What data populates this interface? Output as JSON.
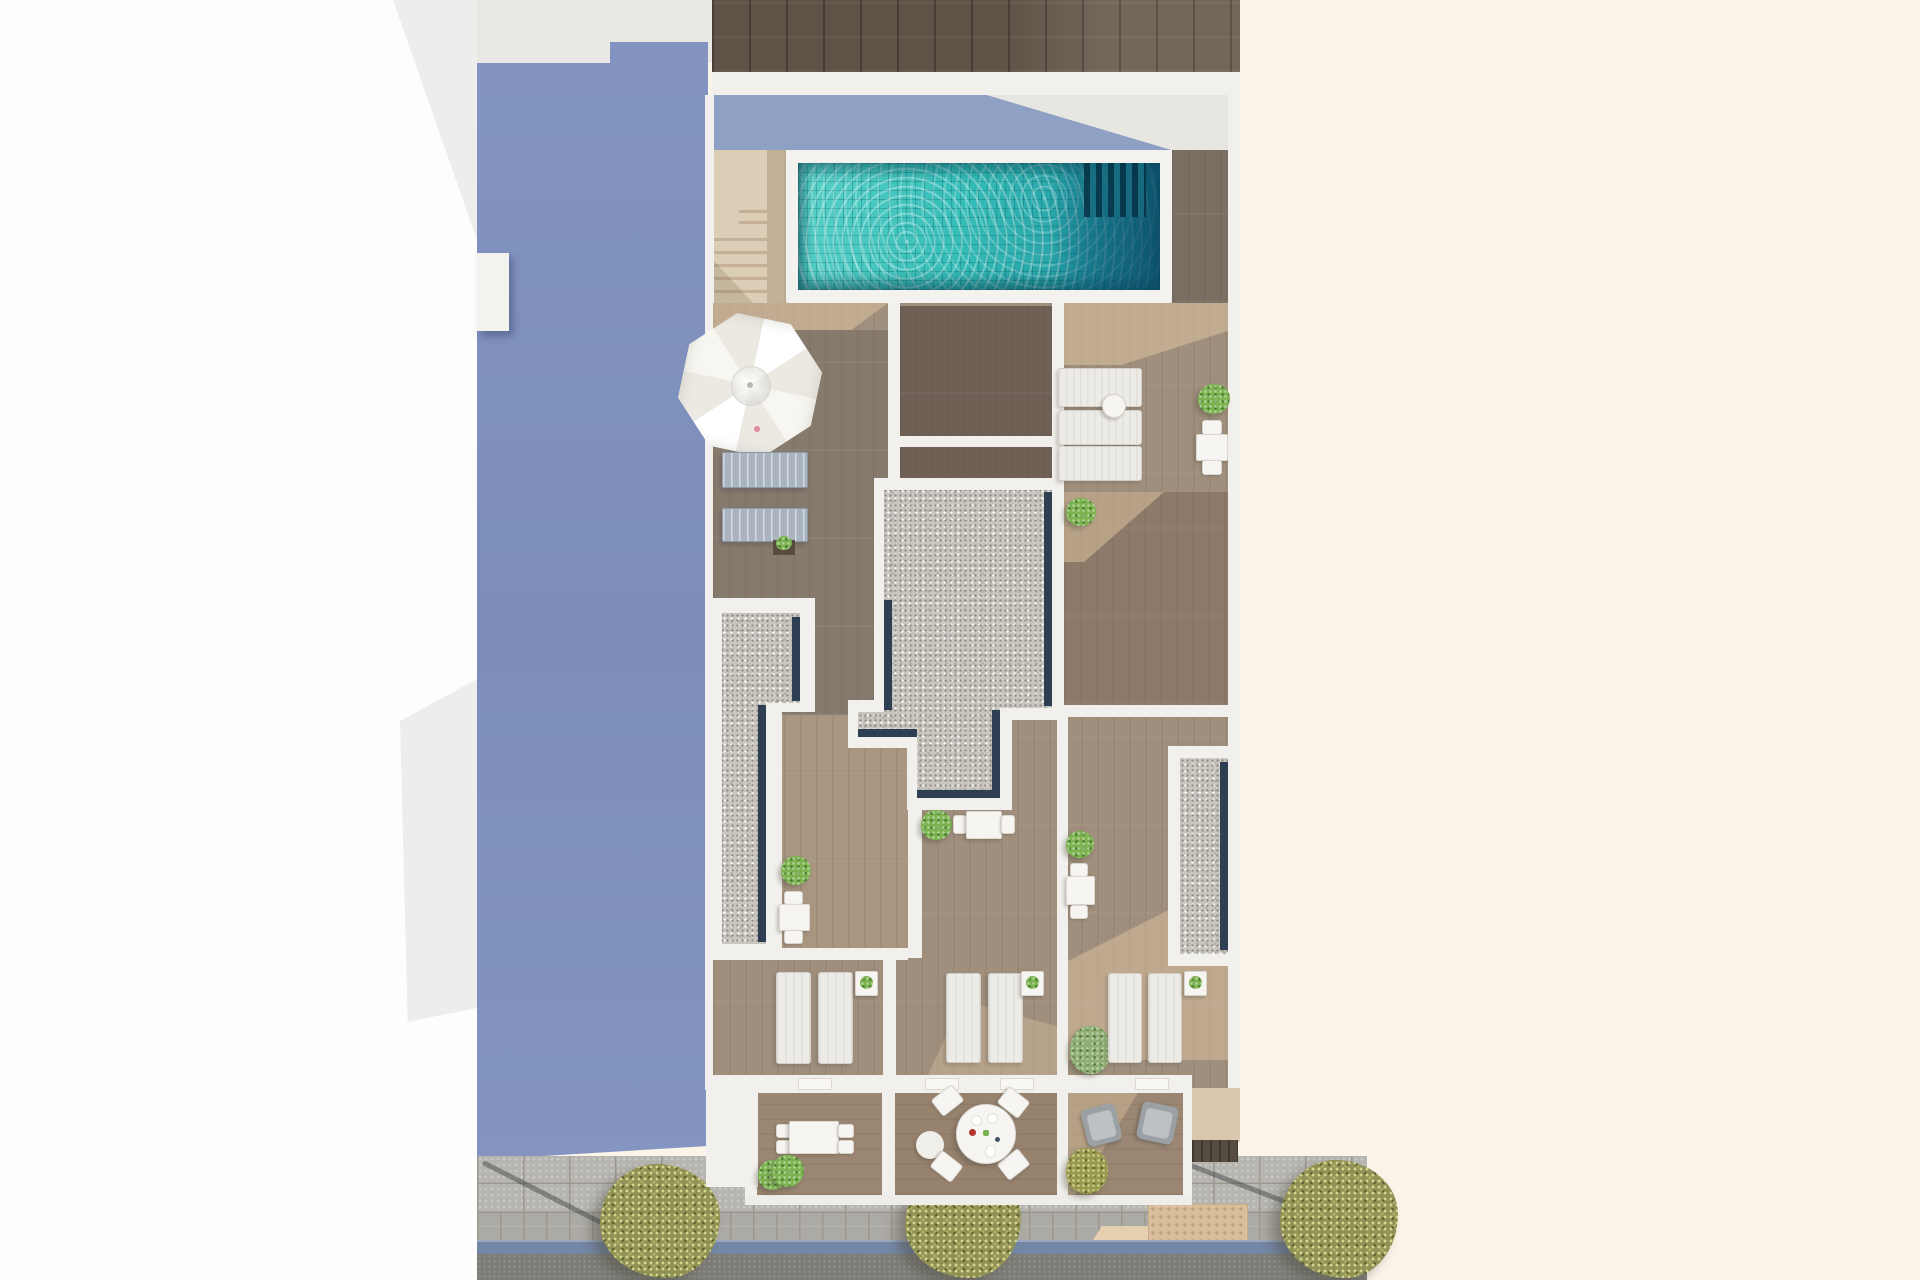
{
  "scene": {
    "title": "Aerial 3D floor-plan rendering",
    "description": "Top-down architectural rendering of a narrow building rooftop and terraces: swimming pool with stairs, parasol with sun loungers, gravel roof sections with dark edge strips, three lounger terraces, three street-level balconies (dining set, round table, armchairs), sidewalk with trees, curb and road; large periwinkle building shadow on the left, cream blank background on the right",
    "no_visible_text": true
  },
  "counts": {
    "swimming_pools": 1,
    "parasols": 1,
    "gray_loungers": 2,
    "white_loungers_horizontal": 3,
    "white_loungers_vertical": 6,
    "terrace_plants": 9,
    "street_trees": 3,
    "balconies": 3,
    "gravel_roof_sections": 3
  },
  "colors": {
    "page-white": "#fdfdfc",
    "page-cream": "#faf4e9",
    "gray-top": "#e9e8e5",
    "margin-shadow": "#ededeb",
    "shadow-blue": "#8495c2",
    "shadow-blue-dark": "#7b8db8",
    "walkway-shadow": "#8fa0c5",
    "wall-white": "#f2f0ec",
    "walkway": "#e8e6e1",
    "wood-top-dark": "#6a5e50",
    "deck-light": "#a08f7d",
    "deck-dark": "#867a6c",
    "court-dark": "#6e6055",
    "deck-warm": "#8d7a69",
    "balcony-wood": "#9a8672",
    "sun-beige": "#e2c9a6",
    "stairs-beige": "#dbcdb6",
    "stairs-shadow": "#c3b096",
    "pool-coping": "#f4f2ee",
    "pool-turquoise": "#35bdb8",
    "pool-turquoise-light": "#5ad2c8",
    "pool-deep": "#0d5b76",
    "gravel": "#c9c6c0",
    "gravel-dot": "#8f8c86",
    "navy-edge": "#2f3f53",
    "lounger-gray": "#a9b4c0",
    "lounger-white": "#edebe6",
    "furniture-white": "#f6f5f2",
    "plant-green": "#7cb350",
    "plant-olive-c": "#97994f",
    "tree-olive": "#8f9155",
    "paver": "#b7b5b0",
    "paver-joint": "#9a988f",
    "paver-band": "#acaaa4",
    "curb-blue": "#7487a4",
    "road": "#7d7c77",
    "tactile-tan": "#d9bf9e",
    "tactile-light": "#e4d0af",
    "planter-dark": "#564c40",
    "armchair-gray": "#9aa0a4",
    "armchair-seat": "#bcc1c4",
    "rug-white": "#f0eee8",
    "umbrella-a": "#ffffff",
    "umbrella-b": "#ebe9e2",
    "umbrella-c": "#f7f6f1",
    "accent-pink": "#e08a9b",
    "accent-red": "#b5352f"
  }
}
